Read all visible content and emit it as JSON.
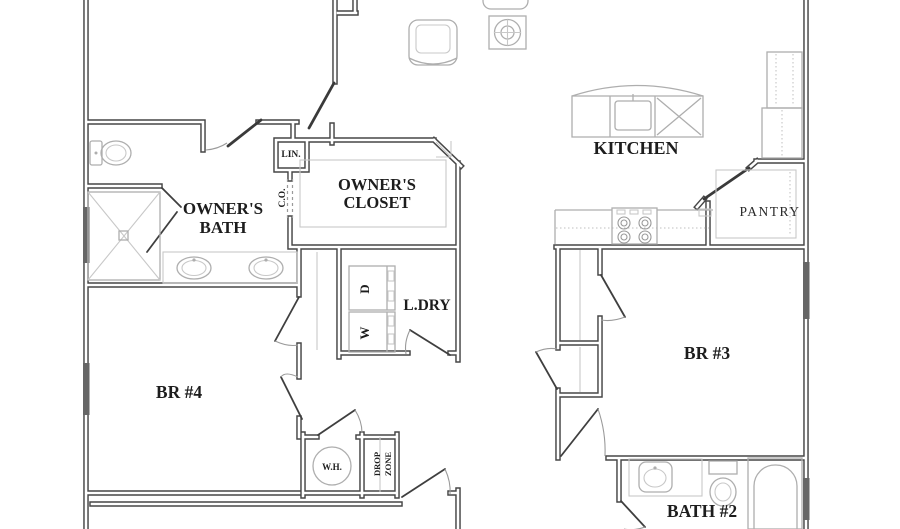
{
  "plan": {
    "title": "single-story floor plan (partial view)",
    "labels": {
      "owners_bath_line1": "OWNER'S",
      "owners_bath_line2": "BATH",
      "owners_closet_line1": "OWNER'S",
      "owners_closet_line2": "CLOSET",
      "kitchen": "KITCHEN",
      "pantry": "PANTRY",
      "laundry": "L.DRY",
      "bedroom4": "BR #4",
      "bedroom3": "BR #3",
      "bath2": "BATH #2",
      "linen": "LIN.",
      "cased_opening": "C.O.",
      "water_heater": "W.H.",
      "drop_zone_line1": "DROP",
      "drop_zone_line2": "ZONE",
      "dryer": "D",
      "washer": "W"
    },
    "fixtures": [
      "toilet",
      "walk-in-shower",
      "double-vanity-sinks",
      "linen-closet",
      "kitchen-island-with-sink",
      "range-cooktop",
      "refrigerator",
      "pantry-shelving",
      "stacked-dryer",
      "stacked-washer",
      "water-heater",
      "drop-zone-bench",
      "bath2-vanity-sink",
      "bath2-toilet",
      "bathtub",
      "armchair",
      "side-table",
      "sofa-edge"
    ],
    "colors": {
      "background": "#ffffff",
      "wall": "#474747",
      "window": "#666666",
      "fixture_line": "#aeaeae",
      "text": "#1d1d1d"
    }
  }
}
